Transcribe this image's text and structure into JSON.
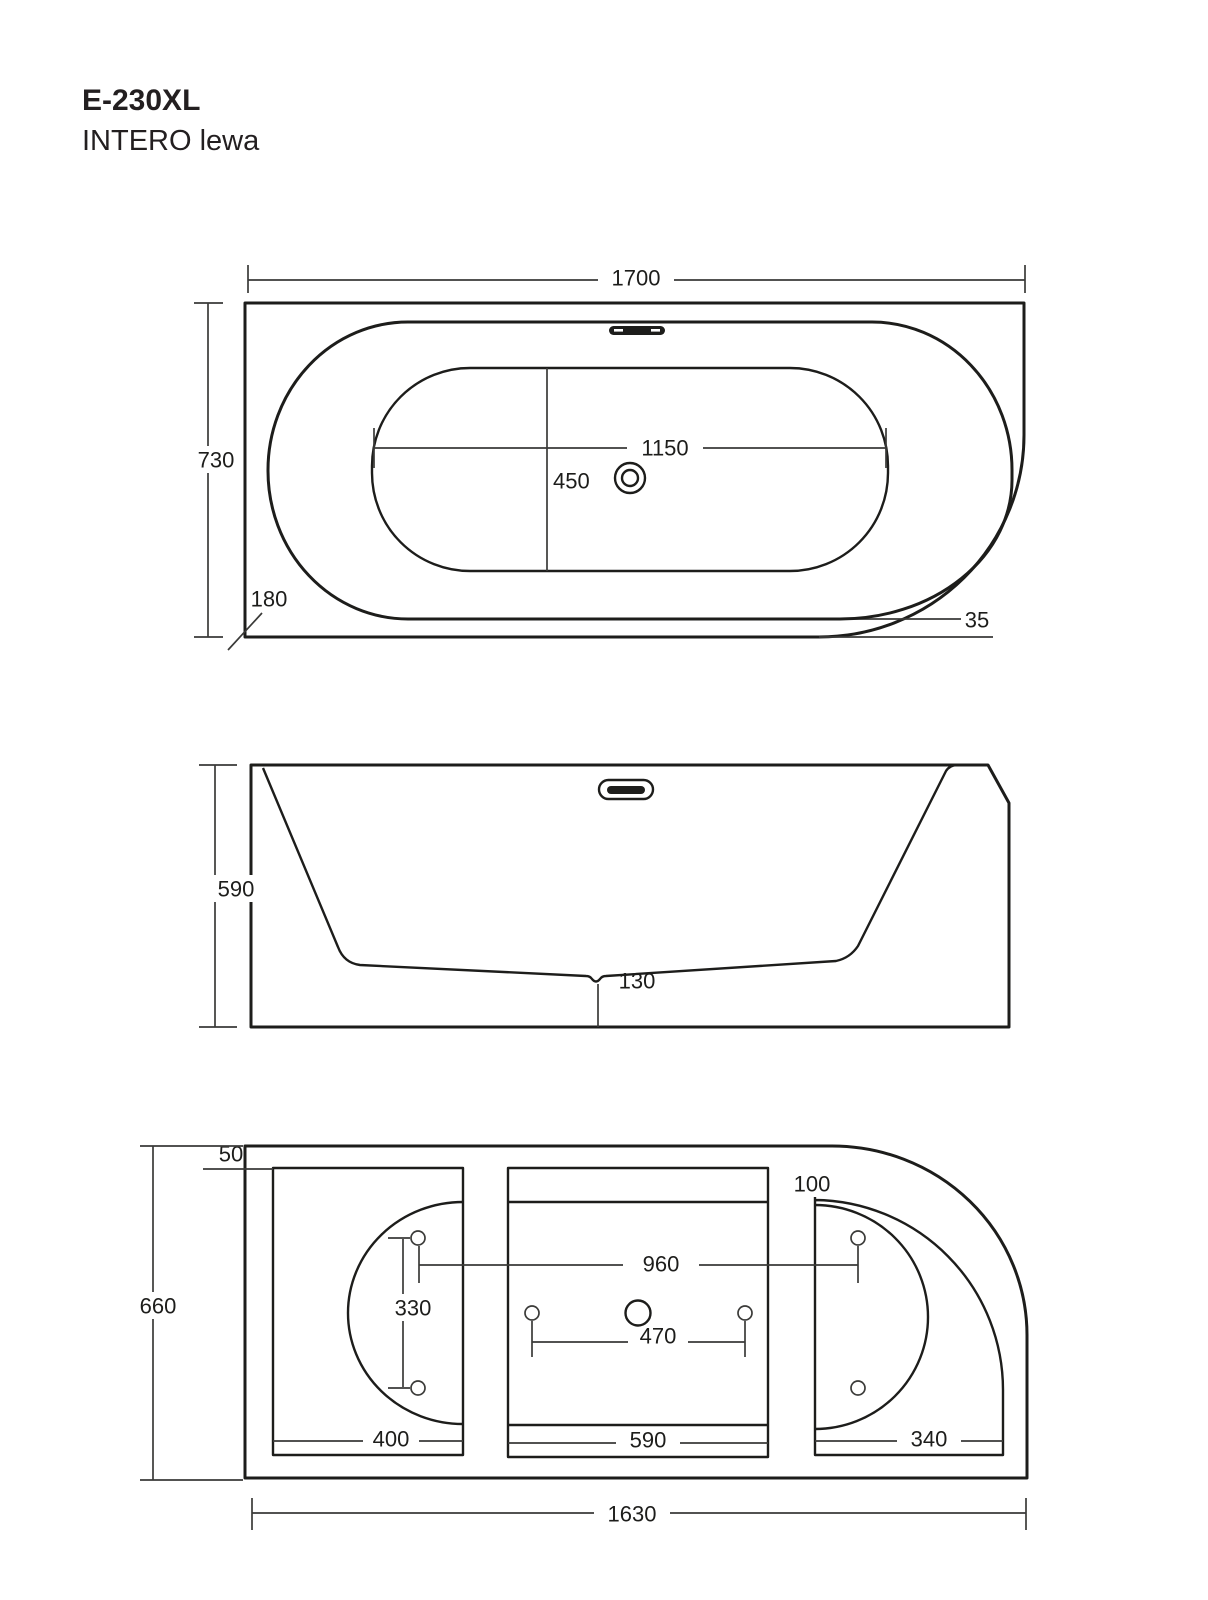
{
  "page": {
    "background": "#ffffff",
    "line_color": "#1d1d1b"
  },
  "header": {
    "model": "E-230XL",
    "variant": "INTERO lewa"
  },
  "views": {
    "top": {
      "name": "top view",
      "dimensions": {
        "overall_length": "1700",
        "overall_width": "730",
        "inner_length": "1150",
        "inner_width": "450",
        "corner_radius": "180",
        "rim_offset": "35"
      }
    },
    "front": {
      "name": "front view",
      "dimensions": {
        "height": "590",
        "bottom_clearance": "130"
      }
    },
    "bottom": {
      "name": "bottom view",
      "dimensions": {
        "frame_edge_offset": "50",
        "corner_frame_offset": "100",
        "overall_width": "660",
        "stud_span_length": "960",
        "stud_span_width": "330",
        "center_stud_span": "470",
        "left_panel_width": "400",
        "center_panel_width": "590",
        "right_panel_width": "340",
        "overall_length": "1630"
      }
    }
  }
}
